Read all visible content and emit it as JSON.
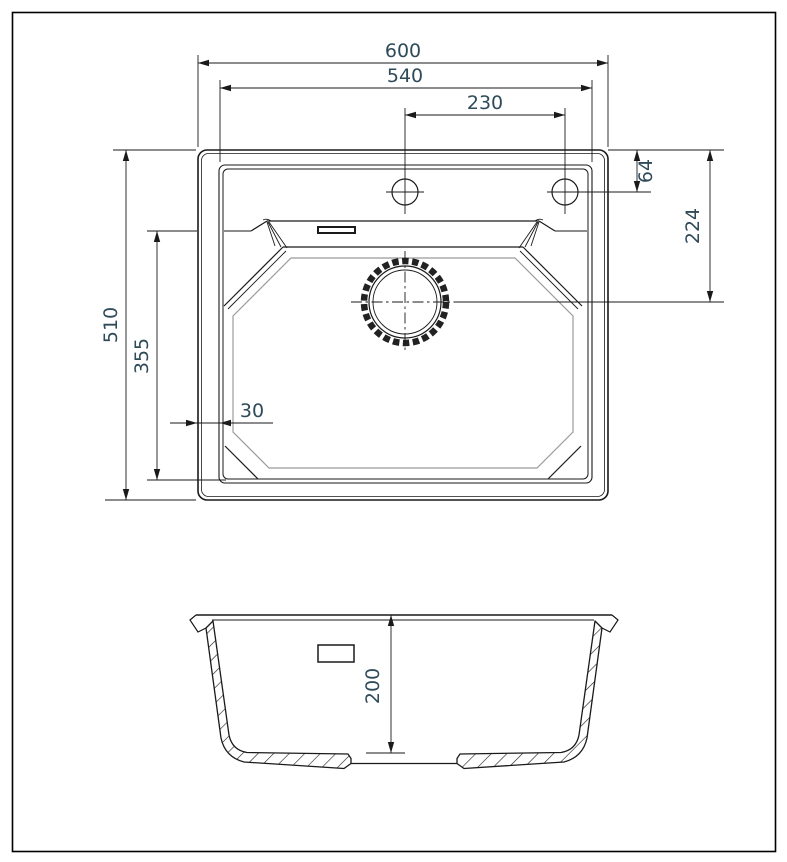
{
  "drawing": {
    "type": "kitchen-sink-dimension-drawing",
    "views": {
      "top_view": "plan view of sink",
      "section_view": "front cross-section of bowl"
    },
    "colors": {
      "line": "#1a1a1a",
      "secondary_line": "#9b9b9b",
      "dimension_text": "#2f4b59",
      "background": "#ffffff"
    },
    "dimensions": {
      "overall_width": "600",
      "rim_width": "540",
      "tap_hole_spacing": "230",
      "tap_hole_offset": "64",
      "drain_offset": "224",
      "overall_depth": "510",
      "bowl_length": "355",
      "rim_margin": "30",
      "bowl_depth": "200"
    }
  }
}
